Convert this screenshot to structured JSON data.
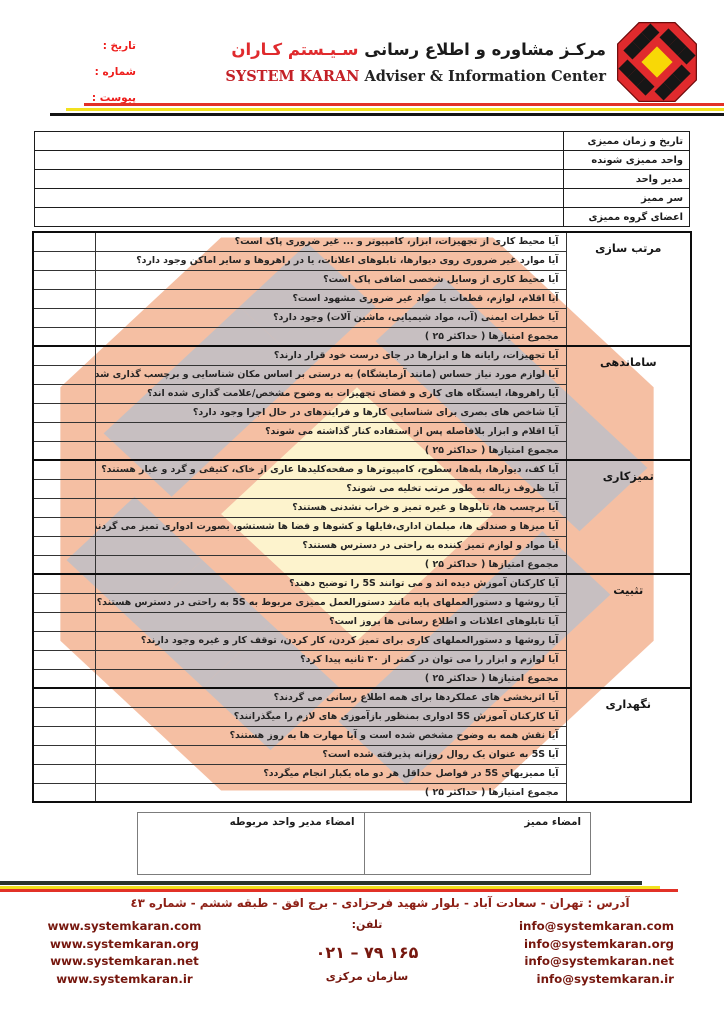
{
  "header": {
    "title_fa_black": "مرکـز مشاوره و اطلاع رسانی",
    "title_fa_red": "سـیـستم کـاران",
    "title_en_red": "SYSTEM KARAN",
    "title_en_black": "Adviser & Information Center",
    "date_label": "تاریخ :",
    "number_label": "شماره :",
    "attachment_label": "پیوست :"
  },
  "info_table": {
    "rows": [
      "تاریخ و زمان ممیزی",
      "واحد ممیزی شونده",
      "مدیر واحد",
      "سر ممیز",
      "اعضای گروه ممیزی"
    ]
  },
  "sections": [
    {
      "title": "مرتب سازی",
      "questions": [
        "آیا محیط کاری از تجهیزات، ابزار، کامپیوتر و ... غیر ضروری پاک است؟",
        "آیا موارد غیر ضروری روی دیوارها، تابلوهای اعلانات، یا در راهروها و سایر اماکن وجود دارد؟",
        "آیا محیط کاری از وسایل شخصی اضافی پاک است؟",
        "آیا اقلام، لوازم، قطعات یا مواد غیر ضروری مشهود است؟",
        "آیا خطرات ایمنی (آب، مواد شیمیایی، ماشین آلات) وجود دارد؟"
      ],
      "total_label": "مجموع امتیازها ( حداکثر ۲۵ )"
    },
    {
      "title": "ساماندهی",
      "questions": [
        "آیا تجهیزات، رایانه ها و ابزارها در جای درست خود قرار دارند؟",
        "آیا لوازم مورد نیاز حساس (مانند آزمایشگاه) به درستی بر اساس مکان شناسایی و برچسب گذاری شده است؟",
        "آیا راهروها، ایستگاه های کاری و فضای تجهیزات به وضوح مشخص/علامت گذاری شده اند؟",
        "آیا شاخص های بصری برای شناسایی کارها و فرایندهای در حال اجرا وجود دارد؟",
        "آیا اقلام و ابزار بلافاصله پس از استفاده کنار گذاشته می شوند؟"
      ],
      "total_label": "مجموع امتیازها ( حداکثر ۲۵ )"
    },
    {
      "title": "تمیزکاری",
      "questions": [
        "آیا کف، دیوارها، پله‌ها، سطوح، کامپیوترها و صفحه‌کلیدها عاری از خاک، کثیفی و گرد و غبار هستند؟",
        "آیا ظروف زباله به طور مرتب تخلیه می شوند؟",
        "آیا برچسب ها، تابلوها و غیره تمیز و خراب نشدنی هستند؟",
        "آیا میزها و صندلی ها، مبلمان اداری،فایلها و کشوها و فضا ها شستشو، بصورت ادواری تمیز می گردند؟",
        "آیا مواد و لوازم تمیز کننده به راحتی در دسترس هستند؟"
      ],
      "total_label": "مجموع امتیازها ( حداکثر ۲۵ )"
    },
    {
      "title": "تثبیت",
      "questions": [
        "آیا کارکنان آموزش دیده اند و می توانند 5S را توضیح دهند؟",
        "آیا روشها و دستورالعملهای پایه مانند دستورالعمل ممیزی مربوط به 5S به راحتی در دسترس هستند؟",
        "آیا تابلوهای اعلانات و اطلاع رسانی ها بروز است؟",
        "آیا روشها و دستورالعملهای کاری برای تمیز کردن، کار کردن، توقف کار و غیره وجود دارند؟",
        "آیا لوازم و ابزار را می توان در کمتر از ۳۰ ثانیه پیدا کرد؟"
      ],
      "total_label": "مجموع امتیازها ( حداکثر ۲۵ )"
    },
    {
      "title": "نگهداری",
      "questions": [
        "آیا اثربخشی های عملکردها برای همه اطلاع رسانی می گردند؟",
        "آیا کارکنان آموزش 5S ادواری بمنظور بازآموزی های لازم را میگذرانند؟",
        "آیا نقش همه به وضوح مشخص شده است و آیا مهارت ها به روز هستند؟",
        "آیا 5S به عنوان یک روال روزانه پذیرفته شده است؟",
        "آیا ممیزیهای 5S در فواصل حداقل هر دو ماه یکبار انجام میگردد؟"
      ],
      "total_label": "مجموع امتیازها ( حداکثر ۲۵ )"
    }
  ],
  "signature": {
    "auditor_label": "امضاء ممیز",
    "manager_label": "امضاء مدیر واحد مربوطه"
  },
  "footer": {
    "address": "آدرس : تهران - سعادت آباد - بلوار شهید فرحزادی - برج افق - طبقه ششم - شماره ٤٣",
    "websites": [
      "www.systemkaran.com",
      "www.systemkaran.org",
      "www.systemkaran.net",
      "www.systemkaran.ir"
    ],
    "emails": [
      "info@systemkaran.com",
      "info@systemkaran.org",
      "info@systemkaran.net",
      "info@systemkaran.ir"
    ],
    "phone_label": "تلفن:",
    "phone_number": "۰۲۱ – ۷۹ ۱۶۵",
    "org_label": "سازمان مرکزی"
  },
  "colors": {
    "logo_red": "#e02a2d",
    "logo_black": "#161616",
    "logo_yellow": "#f8d806",
    "watermark_salmon": "#f5bfa3",
    "watermark_gray": "#c7bfc1",
    "watermark_cream": "#fdf3cd",
    "header_label_red": "#ee1d1b",
    "footer_maroon": "#76170e",
    "address_red": "#8d2016",
    "stripe_red": "#e23127",
    "stripe_yellow": "#f2e11e",
    "stripe_black": "#141414"
  }
}
